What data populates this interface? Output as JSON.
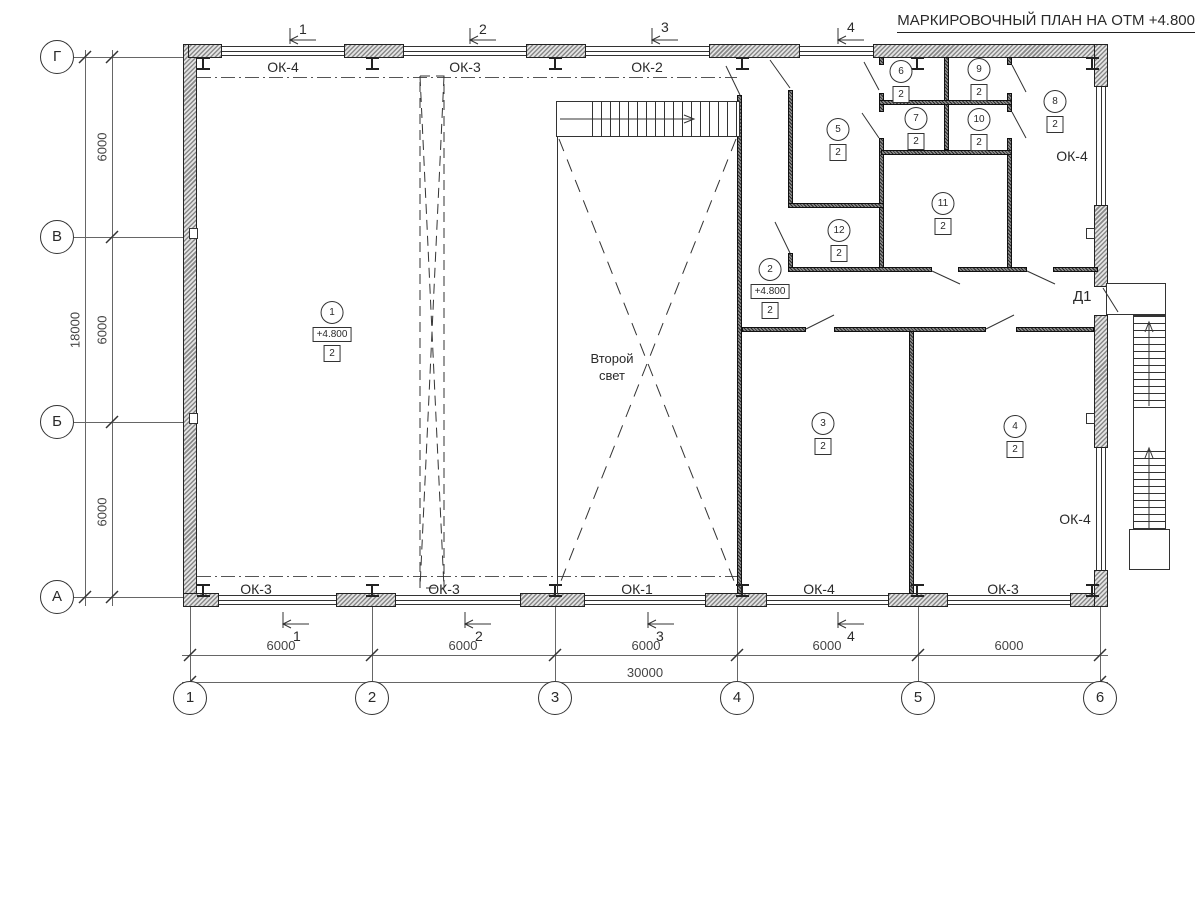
{
  "title": "МАРКИРОВОЧНЫЙ ПЛАН НА ОТМ +4.800",
  "axes": {
    "rows": [
      "Г",
      "В",
      "Б",
      "А"
    ],
    "cols": [
      "1",
      "2",
      "3",
      "4",
      "5",
      "6"
    ]
  },
  "dimensions": {
    "left_bays": [
      "6000",
      "6000",
      "6000"
    ],
    "left_total": "18000",
    "bottom_bays": [
      "6000",
      "6000",
      "6000",
      "6000",
      "6000"
    ],
    "bottom_total": "30000"
  },
  "section_marks": [
    "1",
    "2",
    "3",
    "4"
  ],
  "windows": {
    "top": [
      "ОК-4",
      "ОК-3",
      "ОК-2"
    ],
    "bottom": [
      "ОК-3",
      "ОК-3",
      "ОК-1",
      "ОК-4",
      "ОК-3"
    ],
    "right": [
      "ОК-4",
      "ОК-4"
    ]
  },
  "door_label": "Д1",
  "void_label": "Второй свет",
  "rooms": [
    {
      "number": "1",
      "type": "2",
      "elevation": "+4.800"
    },
    {
      "number": "2",
      "type": "2",
      "elevation": "+4.800"
    },
    {
      "number": "3",
      "type": "2"
    },
    {
      "number": "4",
      "type": "2"
    },
    {
      "number": "5",
      "type": "2"
    },
    {
      "number": "6",
      "type": "2"
    },
    {
      "number": "7",
      "type": "2"
    },
    {
      "number": "8",
      "type": "2"
    },
    {
      "number": "9",
      "type": "2"
    },
    {
      "number": "10",
      "type": "2"
    },
    {
      "number": "11",
      "type": "2"
    },
    {
      "number": "12",
      "type": "2"
    }
  ],
  "colors": {
    "line": "#2a2a2a",
    "wall_hatch": "#8a8a8a",
    "partition": "#555555"
  }
}
